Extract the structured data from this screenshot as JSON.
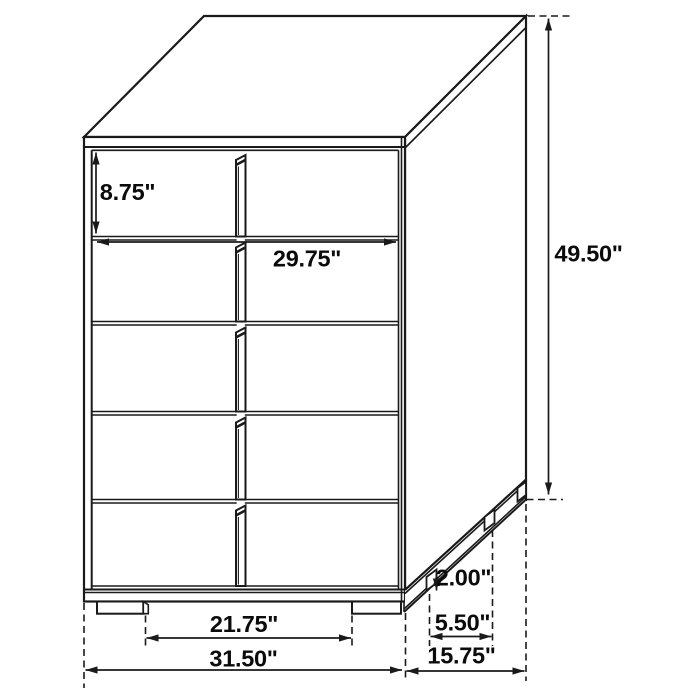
{
  "diagram": {
    "subject": "5-drawer chest dimension drawing",
    "drawer_rows": 5,
    "colors": {
      "line": "#1a1a1a",
      "background": "#ffffff"
    },
    "dimensions": {
      "top_drawer_height": {
        "label": "8.75\"",
        "value": 8.75,
        "unit": "inches"
      },
      "drawer_front_width": {
        "label": "29.75\"",
        "value": 29.75,
        "unit": "inches"
      },
      "overall_height": {
        "label": "49.50\"",
        "value": 49.5,
        "unit": "inches"
      },
      "foot_height": {
        "label": "2.00\"",
        "value": 2.0,
        "unit": "inches"
      },
      "side_foot_spacing": {
        "label": "5.50\"",
        "value": 5.5,
        "unit": "inches"
      },
      "front_foot_spacing": {
        "label": "21.75\"",
        "value": 21.75,
        "unit": "inches"
      },
      "overall_width": {
        "label": "31.50\"",
        "value": 31.5,
        "unit": "inches"
      },
      "overall_depth": {
        "label": "15.75\"",
        "value": 15.75,
        "unit": "inches"
      }
    }
  }
}
